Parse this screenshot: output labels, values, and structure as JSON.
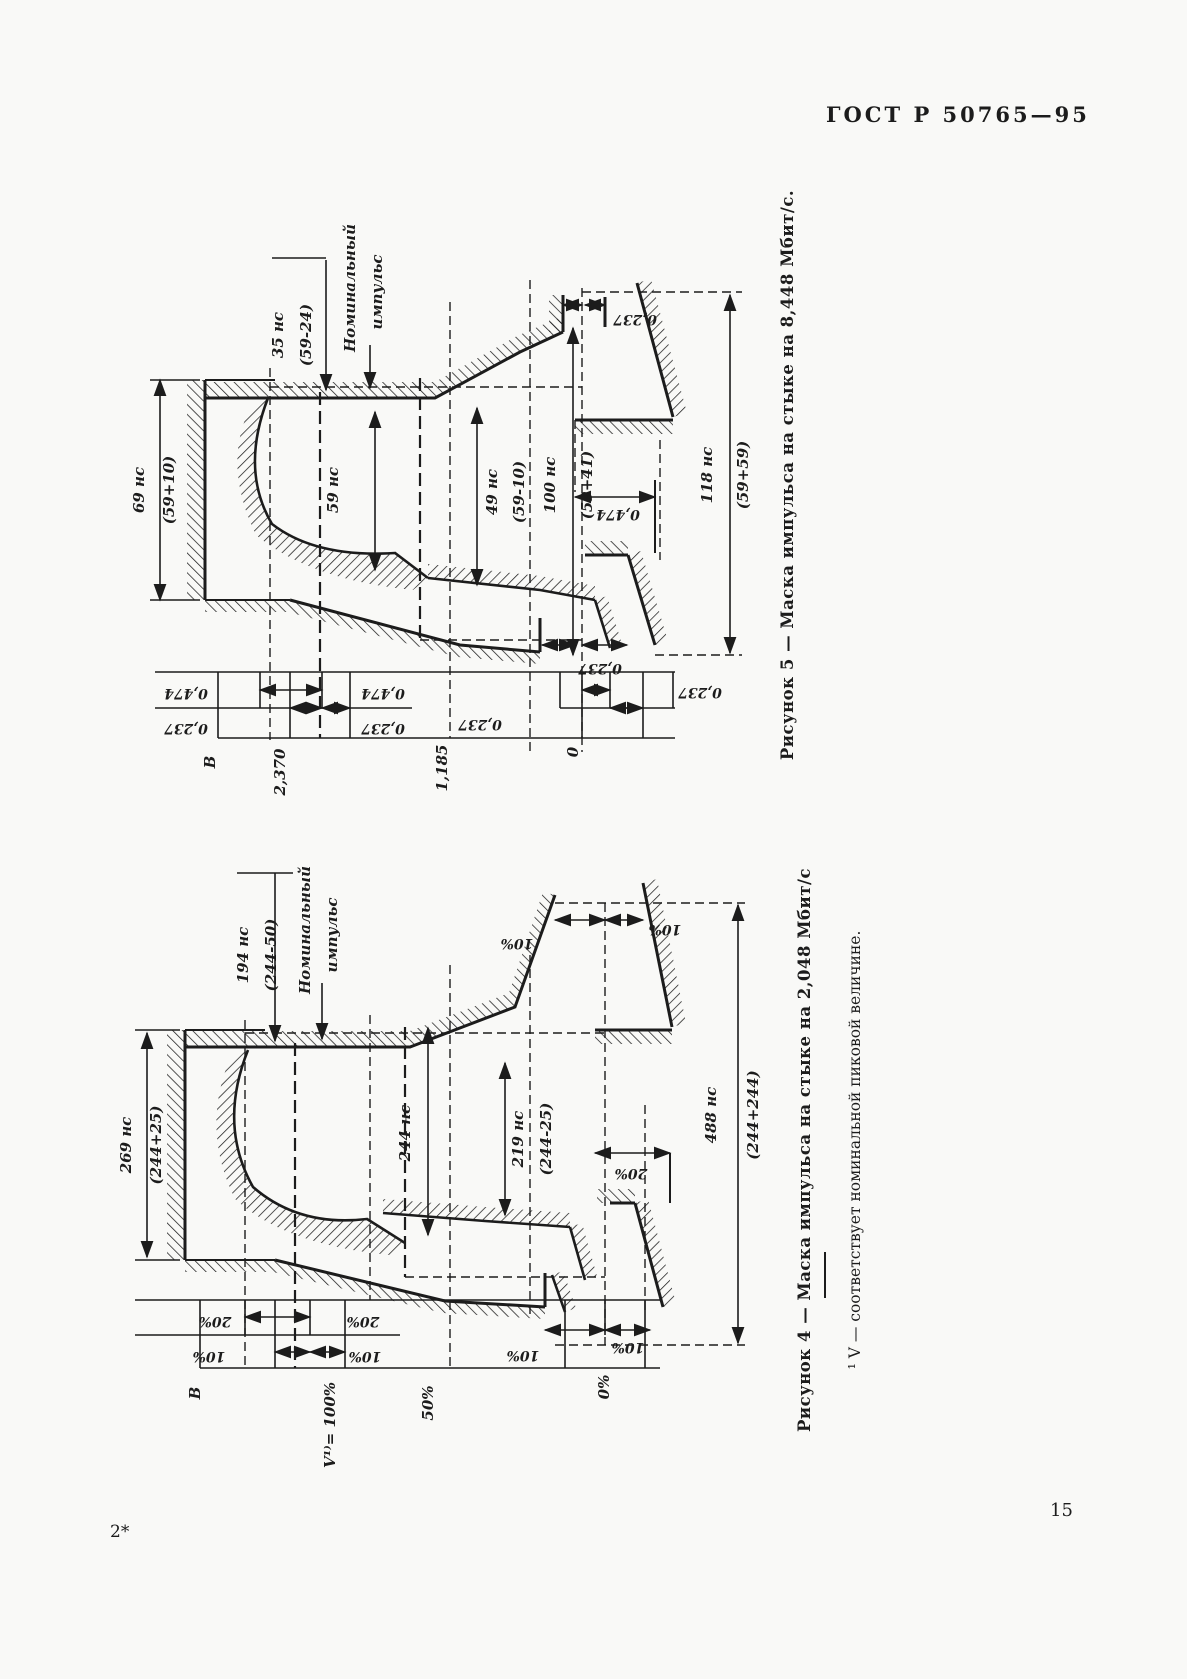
{
  "page": {
    "header": "ГОСТ Р 50765—95",
    "page_number": "15",
    "footer_mark": "2*"
  },
  "figure5": {
    "caption": "Рисунок 5 — Маска импульса на стыке на 8,448 Мбит/с.",
    "dim_35": "35 нс",
    "dim_35_tol": "(59-24)",
    "nominal_line1": "Номинальный",
    "nominal_line2": "импульс",
    "dim_69": "69 нс",
    "dim_69_tol": "(59+10)",
    "dim_59": "59 нс",
    "dim_49": "49 нс",
    "dim_49_tol": "(59-10)",
    "dim_100": "100 нс",
    "dim_100_tol": "(59+41)",
    "dim_118": "118 нс",
    "dim_118_tol": "(59+59)",
    "v_0237": "0,237",
    "v_0474": "0,474",
    "axis_v": "В",
    "axis_2370": "2,370",
    "axis_1185": "1,185",
    "axis_0": "0"
  },
  "figure4": {
    "caption": "Рисунок 4 — Маска импульса на стыке на 2,048 Мбит/с",
    "dim_194": "194 нс",
    "dim_194_tol": "(244-50)",
    "nominal_line1": "Номинальный",
    "nominal_line2": "импульс",
    "dim_269": "269 нс",
    "dim_269_tol": "(244+25)",
    "dim_244": "244 нс",
    "dim_219": "219 нс",
    "dim_219_tol": "(244-25)",
    "dim_488": "488 нс",
    "dim_488_tol": "(244+244)",
    "pct_10": "10%",
    "pct_20": "20%",
    "axis_v": "В",
    "axis_100": "V¹⁾= 100%",
    "axis_50": "50%",
    "axis_0": "0%"
  },
  "footnote": "¹ V — соответствует номинальной пиковой величине."
}
